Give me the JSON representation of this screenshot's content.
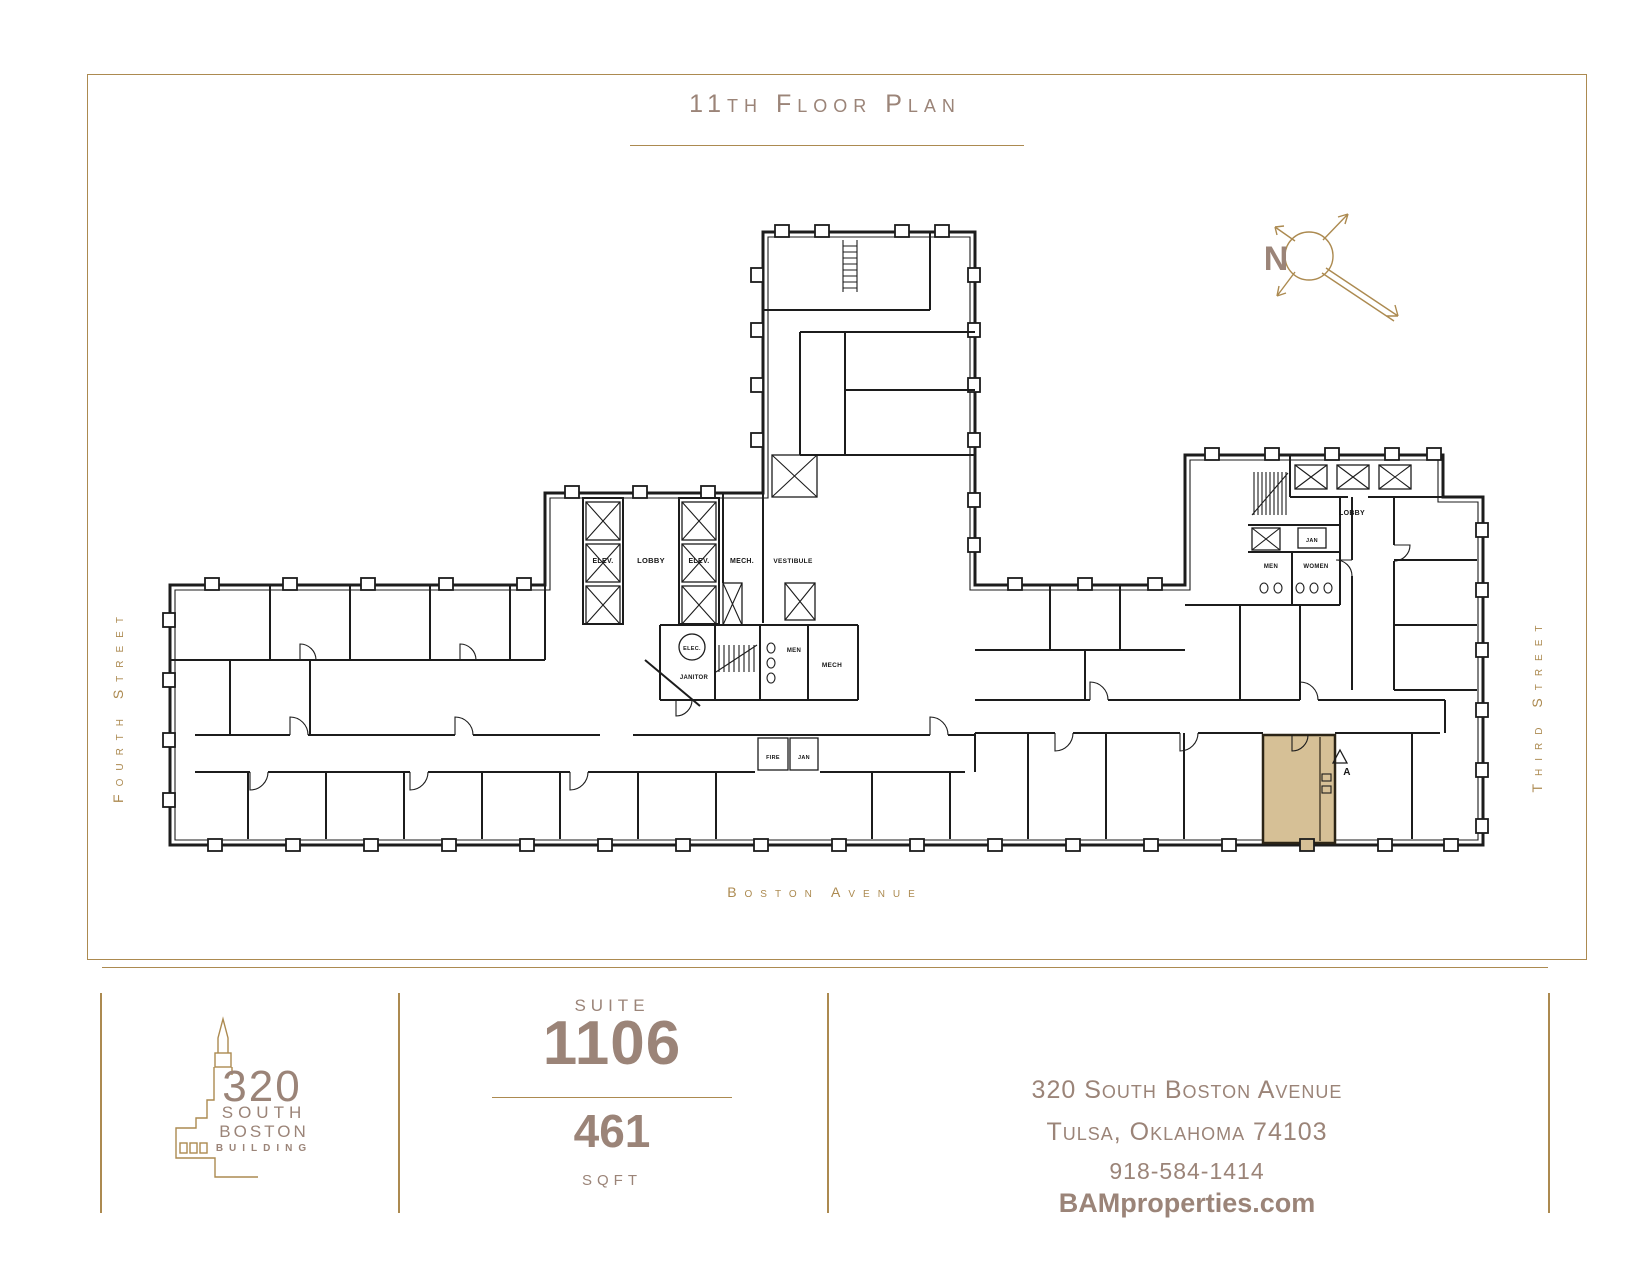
{
  "page": {
    "title": "11th Floor Plan"
  },
  "streets": {
    "west": "Fourth Street",
    "east": "Third Street",
    "south": "Boston Avenue"
  },
  "compass": {
    "north_label": "N"
  },
  "plan": {
    "rooms": {
      "elev_left": "ELEV.",
      "lobby_core": "LOBBY",
      "elev_right": "ELEV.",
      "mech_core": "MECH.",
      "vestibule": "VESTIBULE",
      "elec": "ELEC.",
      "janitor": "JANITOR",
      "men_core": "MEN",
      "mech_lower": "MECH",
      "fire": "FIRE",
      "jan_corridor": "JAN",
      "lobby_east": "LOBBY",
      "jan_east": "JAN",
      "men_east": "MEN",
      "women_east": "WOMEN",
      "suite_marker": "A"
    }
  },
  "footer": {
    "logo": {
      "number": "320",
      "line1": "SOUTH",
      "line2": "BOSTON",
      "line3": "BUILDING"
    },
    "suite": {
      "label": "SUITE",
      "number": "1106",
      "area": "461",
      "unit": "SQFT"
    },
    "contact": {
      "address_line1": "320 South Boston Avenue",
      "address_line2": "Tulsa, Oklahoma 74103",
      "phone": "918-584-1414",
      "website": "BAMproperties.com"
    }
  },
  "colors": {
    "gold": "#ac8a50",
    "taupe": "#9b8478",
    "ink": "#1c1c1c",
    "suite_fill": "#d6c096"
  }
}
